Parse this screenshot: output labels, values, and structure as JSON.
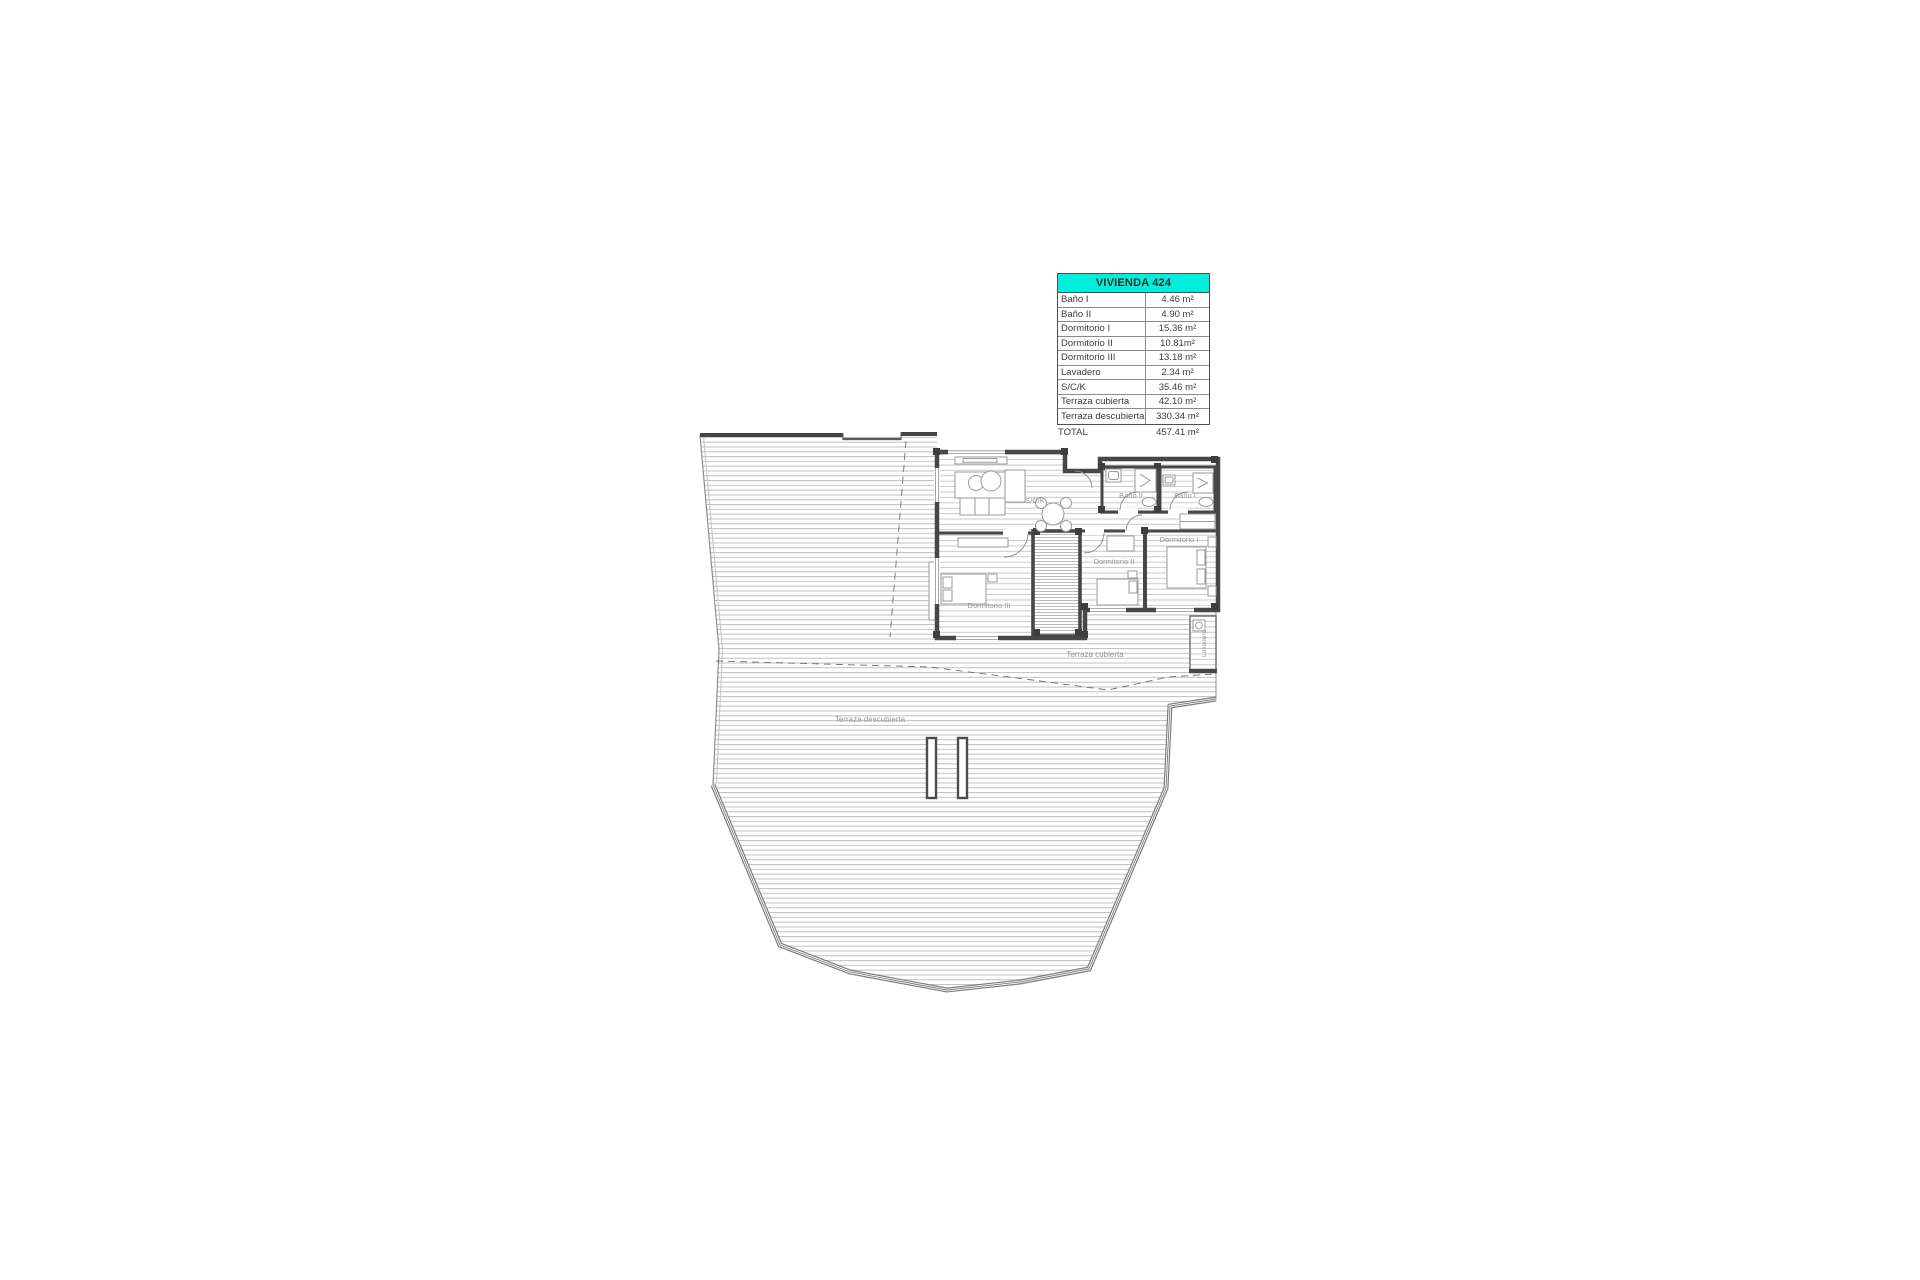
{
  "panel": {
    "title": "VIVIENDA 424",
    "rows": [
      {
        "label": "Baño I",
        "value": "4.46 m²"
      },
      {
        "label": "Baño II",
        "value": "4.90 m²"
      },
      {
        "label": "Dormitorio I",
        "value": "15.36 m²"
      },
      {
        "label": "Dormitorio II",
        "value": "10.81m²"
      },
      {
        "label": "Dormitorio III",
        "value": "13.18 m²"
      },
      {
        "label": "Lavadero",
        "value": "2.34 m²"
      },
      {
        "label": "S/C/K",
        "value": "35.46 m²"
      },
      {
        "label": "Terraza cubierta",
        "value": "42.10 m²"
      },
      {
        "label": "Terraza descubierta",
        "value": "330.34 m²"
      }
    ],
    "total": {
      "label": "TOTAL",
      "value": "457.41 m²"
    },
    "colors": {
      "header_bg": "#00EFDC",
      "text": "#3c3c3c",
      "border": "#4f4f4f"
    }
  },
  "plan": {
    "labels": {
      "sck": "S/C/K",
      "bano1": "Baño I",
      "bano2": "Baño II",
      "dorm1": "Dormitorio I",
      "dorm2": "Dormitorio II",
      "dorm3": "Dormitorio III",
      "lavadero": "Lavadero",
      "terraza_cubierta": "Terraza cubierta",
      "terraza_descubierta": "Terraza descubierta"
    }
  }
}
